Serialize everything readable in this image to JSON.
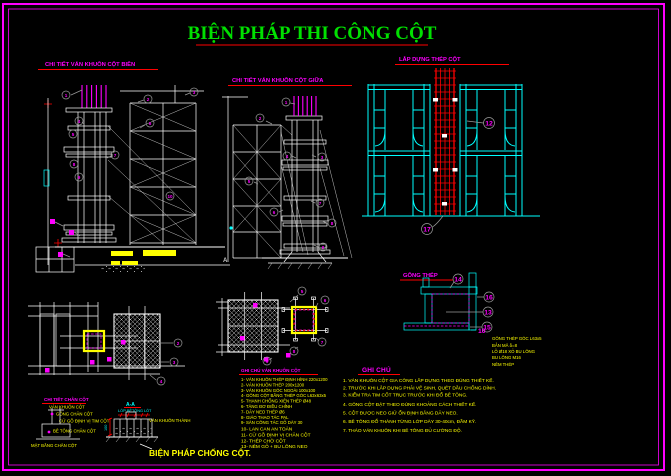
{
  "page": {
    "title": "BIỆN PHÁP THI CÔNG CỘT"
  },
  "colors": {
    "border": "#ff00ff",
    "title": "#00e000",
    "underline": "#ff0000",
    "frame_cyan": "#00ffff",
    "rebar_red": "#ff0000",
    "note_yellow": "#ffff00"
  },
  "left_elevation": {
    "title": "CHI TIẾT VÁN KHUÔN CỘT BIÊN",
    "callouts": [
      "1",
      "2",
      "3",
      "4",
      "5",
      "6",
      "7",
      "8",
      "9",
      "10"
    ]
  },
  "middle_elevation": {
    "title": "CHI TIẾT VÁN KHUÔN CỘT GIỮA",
    "callouts": [
      "1",
      "2",
      "3",
      "4",
      "5",
      "6",
      "7",
      "8",
      "9"
    ],
    "section_mark": "A"
  },
  "rebar_erection": {
    "title": "LẮP DỰNG THÉP CỘT",
    "callout_top": "12",
    "callout_bottom": "17"
  },
  "steel_collar": {
    "title": "GÔNG THÉP",
    "callouts": [
      "14",
      "16",
      "13",
      "15"
    ],
    "ref_label": "10",
    "labels": [
      "GÔNG THÉP GÓC L63x5",
      "BẢN MÃ δ=8",
      "LỖ Ø18 XỎ BU LÔNG",
      "BU LÔNG M16",
      "NÊM THÉP"
    ]
  },
  "plan_left": {
    "callouts": [
      "2",
      "3",
      "4"
    ]
  },
  "plan_middle": {
    "callouts": [
      "5",
      "6",
      "7",
      "8",
      "9"
    ]
  },
  "formwork_notes": {
    "title": "GHI CHÚ VÁN KHUÔN CỘT",
    "lines": [
      "1- VÁN KHUÔN THÉP ĐỊNH HÌNH 220x1200",
      "2- VÁN KHUÔN THÉP 200x1200",
      "3- VÁN KHUÔN GÓC NGOÀI 100x100",
      "4- GÔNG CỘT BẰNG THÉP GÓC L63x63x5",
      "5- THANH CHỐNG XIÊN THÉP Ø48",
      "6- TĂNG ĐƠ ĐIỀU CHỈNH",
      "7- DÂY NEO THÉP Ø6",
      "8- GIÁO THAO TÁC PAL",
      "9- SÀN CÔNG TÁC GỖ DÀY 30",
      "10- LAN CAN AN TOÀN",
      "11- CỮ GỖ ĐỊNH VỊ CHÂN CỘT",
      "12- THÉP CHỜ CỘT",
      "13- NÊM GỖ + BU LÔNG NEO"
    ]
  },
  "general_notes": {
    "title": "GHI CHÚ",
    "lines": [
      "1. VÁN KHUÔN CỘT GIA CÔNG LẮP DỰNG THEO ĐÚNG THIẾT KẾ.",
      "2. TRƯỚC KHI LẮP DỰNG PHẢI VỆ SINH, QUÉT DẦU CHỐNG DÍNH.",
      "3. KIỂM TRA TIM CỐT TRỤC TRƯỚC KHI ĐỔ BÊ TÔNG.",
      "4. GÔNG CỘT ĐẶT THEO ĐÚNG KHOẢNG CÁCH THIẾT KẾ.",
      "5. CỘT ĐƯỢC NEO GIỮ ỔN ĐỊNH BẰNG DÂY NEO.",
      "6. BÊ TÔNG ĐỔ THÀNH TỪNG LỚP DÀY 30-40cm, ĐẦM KỸ.",
      "7. THÁO VÁN KHUÔN KHI BÊ TÔNG ĐỦ CƯỜNG ĐỘ."
    ]
  },
  "detail_1": {
    "title": "CHI TIẾT CHÂN CỘT",
    "labels": [
      "VÁN KHUÔN CỘT",
      "GÔNG CHÂN CỘT",
      "CỮ GỖ ĐỊNH VỊ TIM CỘT",
      "BÊ TÔNG CHÂN CỘT"
    ],
    "bottom_label": "MẶT BẰNG CHÂN CỘT"
  },
  "detail_2": {
    "label": "A-A",
    "note": "LỚP BÊTÔNG LÓT",
    "dim": "100",
    "label_right": "VÁN KHUÔN THÀNH"
  },
  "bottom_text": {
    "big_line": "BIỆN PHÁP CHỐNG CỘT."
  }
}
